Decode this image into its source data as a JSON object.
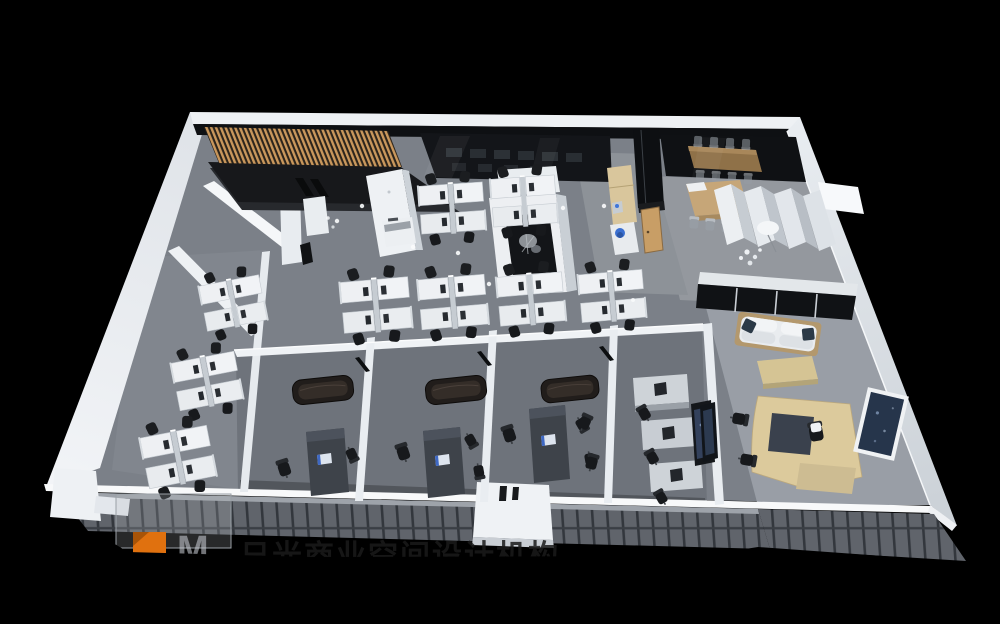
{
  "image": {
    "kind": "3d-office-floorplan-render",
    "background": "#000000"
  },
  "watermark": {
    "logo_letter": "M",
    "logo_color": "#e0710f",
    "company_text": "日光商业空间设计机构",
    "text_color": "#1a1a1a"
  },
  "palette": {
    "carpet": "#7b8088",
    "walls_white": "#eef1f4",
    "dark_glass": "#0e1013",
    "wood_slats": "#c9975c",
    "wood_door": "#c89e66",
    "conference_table_wood": "#8f7148",
    "meeting_table_wood": "#c6a678",
    "exec_desk_wood": "#dcca9c",
    "office_desk_dark": "#3e434a",
    "sofa_dark": "#211d1b",
    "sofa_white": "#e9ecef",
    "accent_blue_bin": "#3a6fd0",
    "facade_band": "#60646b"
  }
}
